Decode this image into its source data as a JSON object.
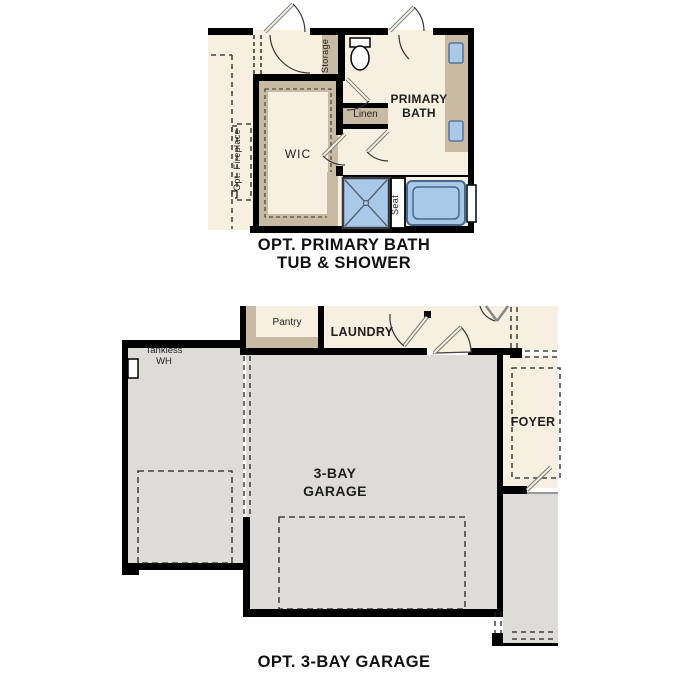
{
  "colors": {
    "floor_cream": "#f7efe0",
    "wall_black": "#000000",
    "casework_tan": "#c9bba3",
    "garage_gray": "#dedcd9",
    "fixture_blue": "#a9c9e9",
    "fixture_blue_border": "#47688e"
  },
  "top_plan": {
    "caption_line1": "OPT. PRIMARY BATH",
    "caption_line2": "TUB & SHOWER",
    "rooms": {
      "primary_bath": "PRIMARY BATH",
      "wic": "WIC"
    },
    "labels": {
      "storage": "Storage",
      "linen": "Linen",
      "opt_fireplace": "Opt. Fireplace",
      "seat": "Seat"
    }
  },
  "bottom_plan": {
    "caption": "OPT. 3-BAY GARAGE",
    "rooms": {
      "garage": "3-BAY GARAGE",
      "laundry": "LAUNDRY",
      "foyer": "FOYER",
      "pantry": "Pantry"
    },
    "labels": {
      "tankless_wh": "Tankless WH"
    }
  }
}
